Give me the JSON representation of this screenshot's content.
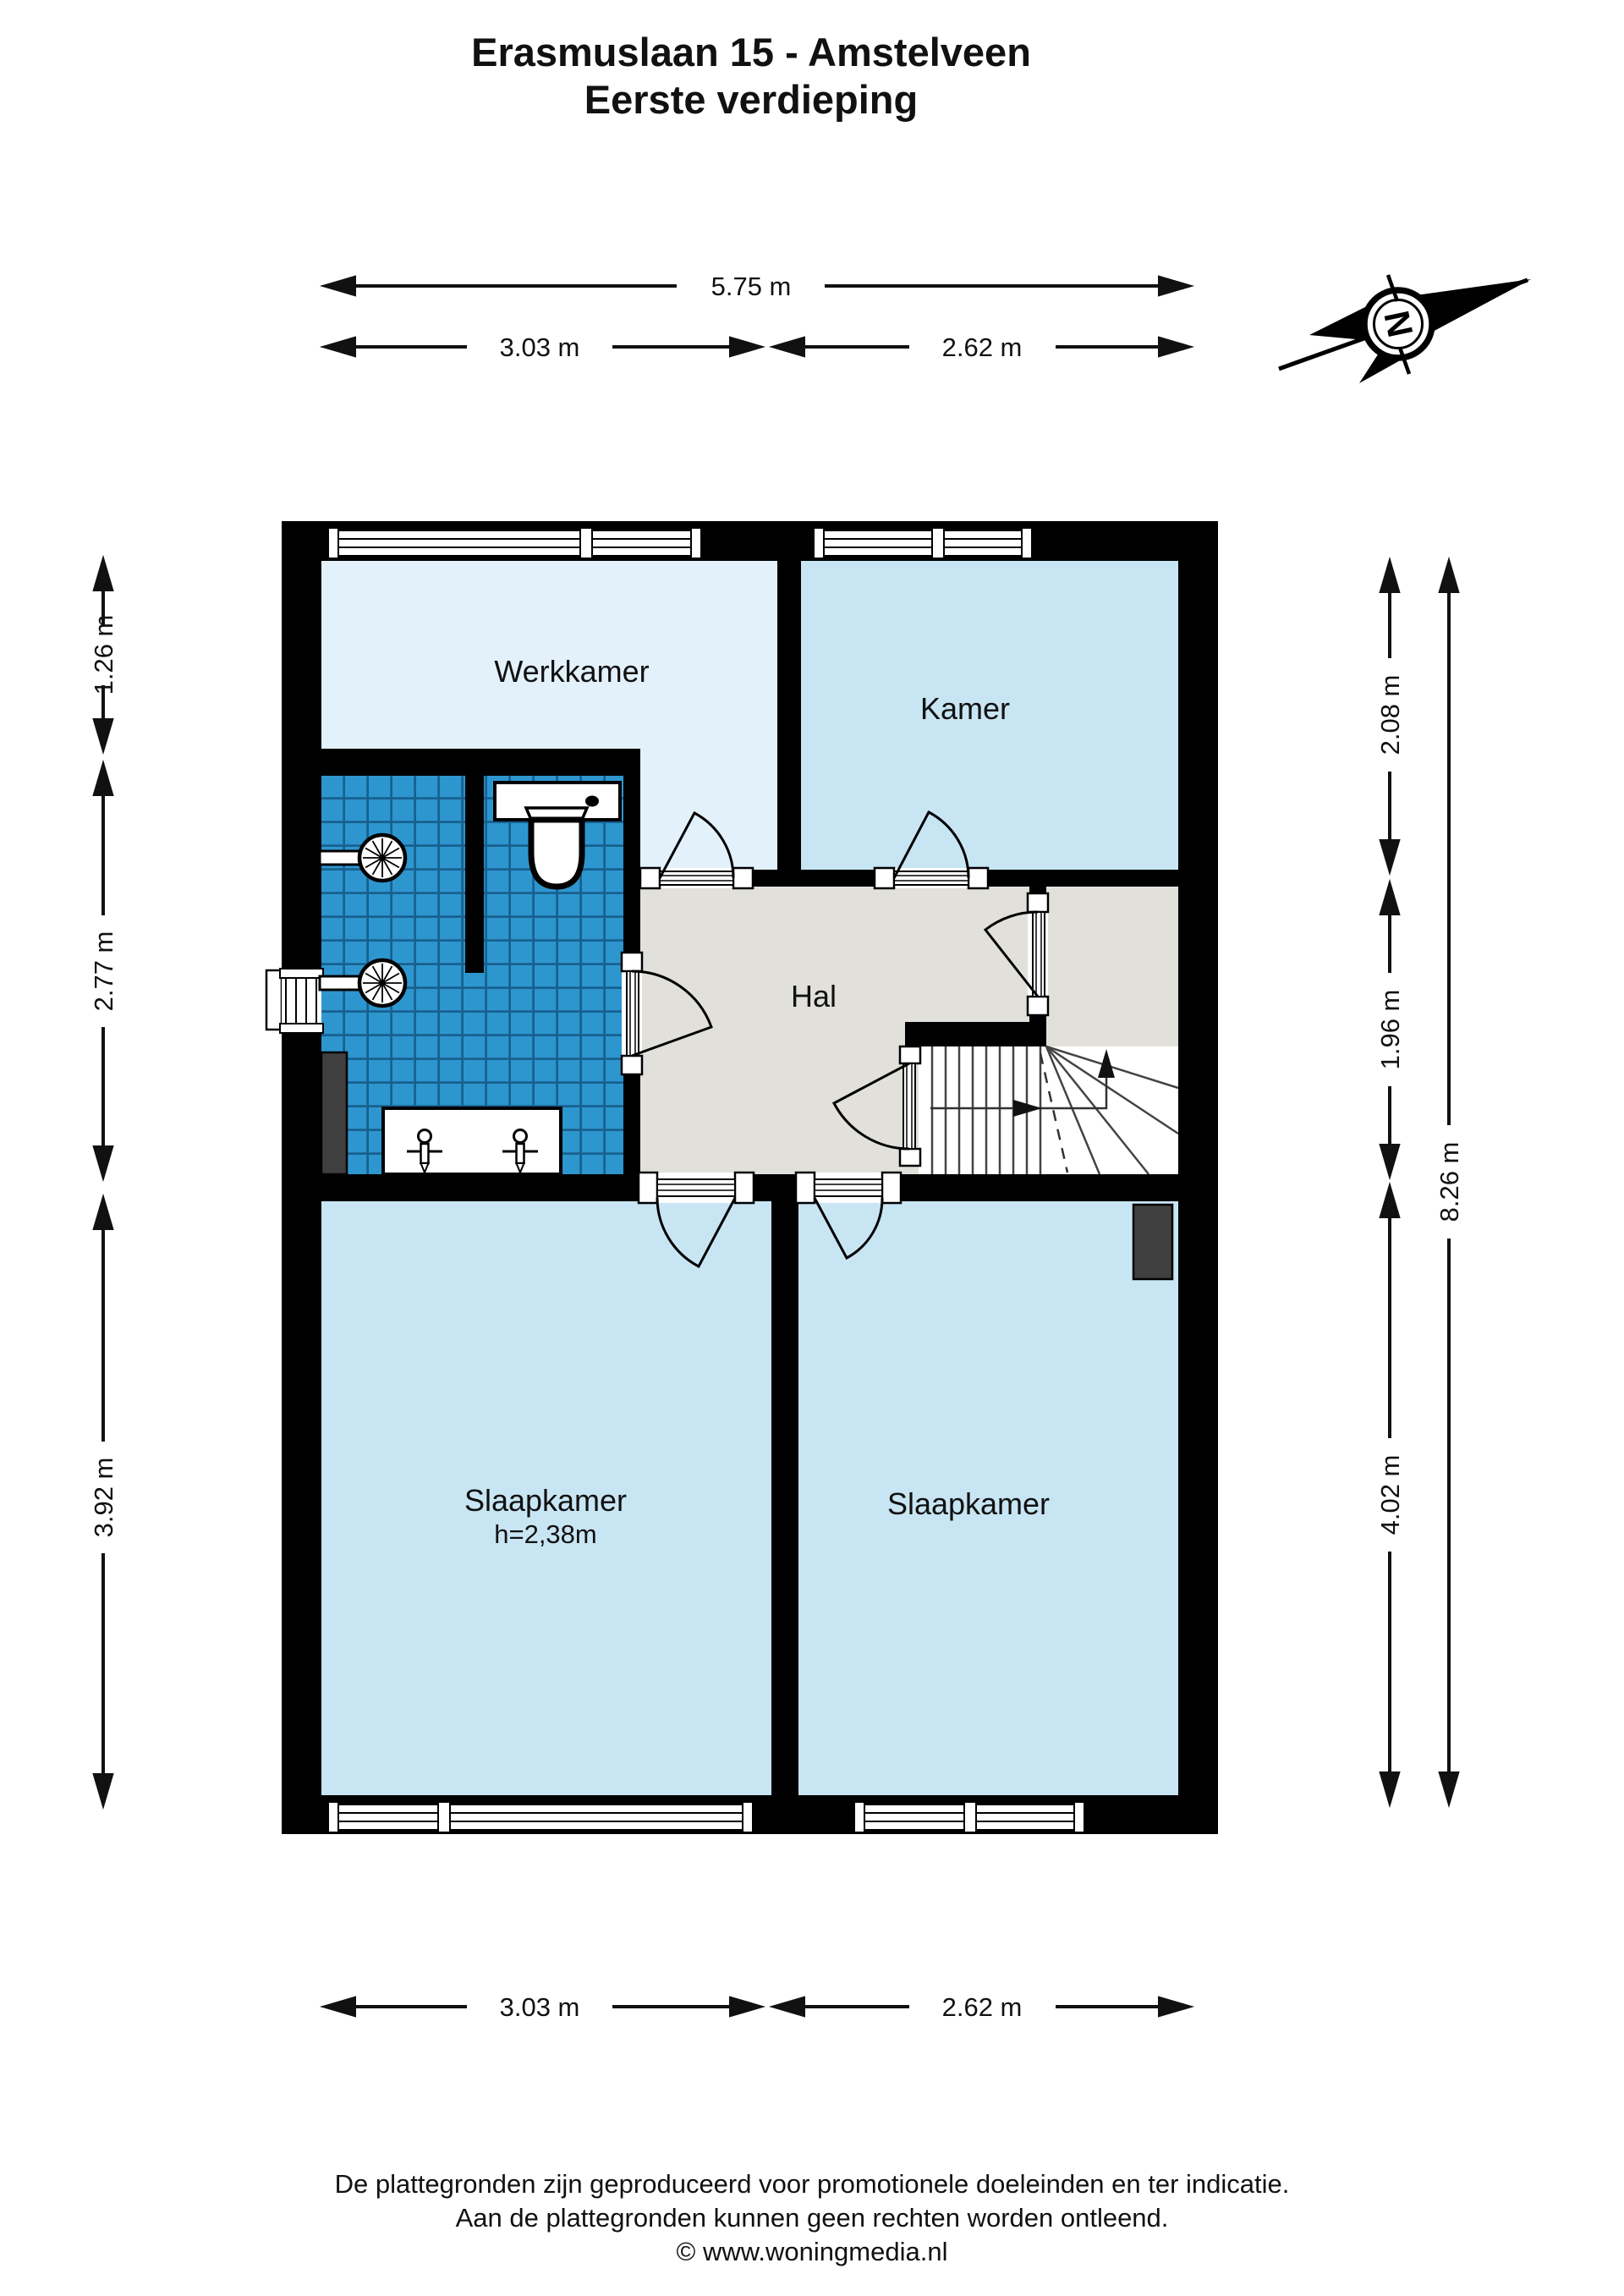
{
  "title": {
    "line1": "Erasmuslaan 15 - Amstelveen",
    "line2": "Eerste verdieping"
  },
  "compass": {
    "label": "N"
  },
  "rooms": {
    "werkkamer": {
      "label": "Werkkamer"
    },
    "kamer": {
      "label": "Kamer"
    },
    "hal": {
      "label": "Hal"
    },
    "slaapkamer_left": {
      "label": "Slaapkamer",
      "height_note": "h=2,38m"
    },
    "slaapkamer_right": {
      "label": "Slaapkamer"
    }
  },
  "dimensions": {
    "top_total": {
      "label": "5.75 m"
    },
    "top_left": {
      "label": "3.03 m"
    },
    "top_right": {
      "label": "2.62 m"
    },
    "left_upper": {
      "label": "1.26 m"
    },
    "left_middle": {
      "label": "2.77 m"
    },
    "left_lower": {
      "label": "3.92 m"
    },
    "right_upper": {
      "label": "2.08 m"
    },
    "right_middle": {
      "label": "1.96 m"
    },
    "right_lower": {
      "label": "4.02 m"
    },
    "right_total": {
      "label": "8.26 m"
    },
    "bottom_left": {
      "label": "3.03 m"
    },
    "bottom_right": {
      "label": "2.62 m"
    }
  },
  "footer": {
    "line1": "De plattegronden zijn geproduceerd voor promotionele doeleinden en ter indicatie.",
    "line2": "Aan de plattegronden kunnen geen rechten worden ontleend.",
    "line3": "© www.woningmedia.nl"
  },
  "colors": {
    "wall": "#000000",
    "werkkamer_fill": "#e2f1fa",
    "room_fill": "#c8e5f3",
    "hall_fill": "#e1e0da",
    "tile_fill": "#2e96cf",
    "tile_line": "#17618f",
    "stairs_line": "#444444",
    "radiator": "#3f3f3f"
  }
}
